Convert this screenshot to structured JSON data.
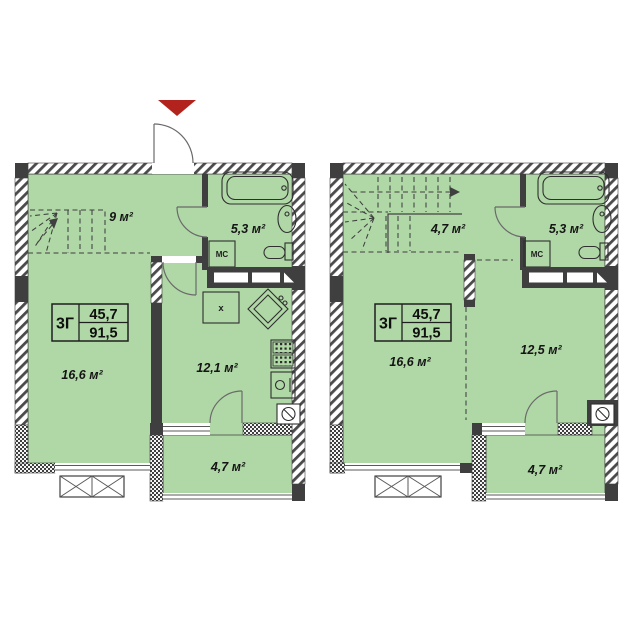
{
  "palette": {
    "room_green": "#b0d7a6",
    "wall_dark": "#3f3f3f",
    "arrow_red": "#b3231e"
  },
  "plans": {
    "left": {
      "type_label": "3Г",
      "area_upper": "45,7",
      "area_total": "91,5",
      "rooms": {
        "hall": "9 м²",
        "bathroom": "5,3 м²",
        "living": "16,6 м²",
        "kitchen": "12,1 м²",
        "balcony": "4,7 м²"
      },
      "closet": "МС",
      "appliance": "х"
    },
    "right": {
      "type_label": "3Г",
      "area_upper": "45,7",
      "area_total": "91,5",
      "rooms": {
        "hall": "4,7 м²",
        "bathroom": "5,3 м²",
        "room_large": "16,6 м²",
        "room_small": "12,5 м²",
        "balcony": "4,7 м²"
      },
      "closet": "МС"
    }
  }
}
